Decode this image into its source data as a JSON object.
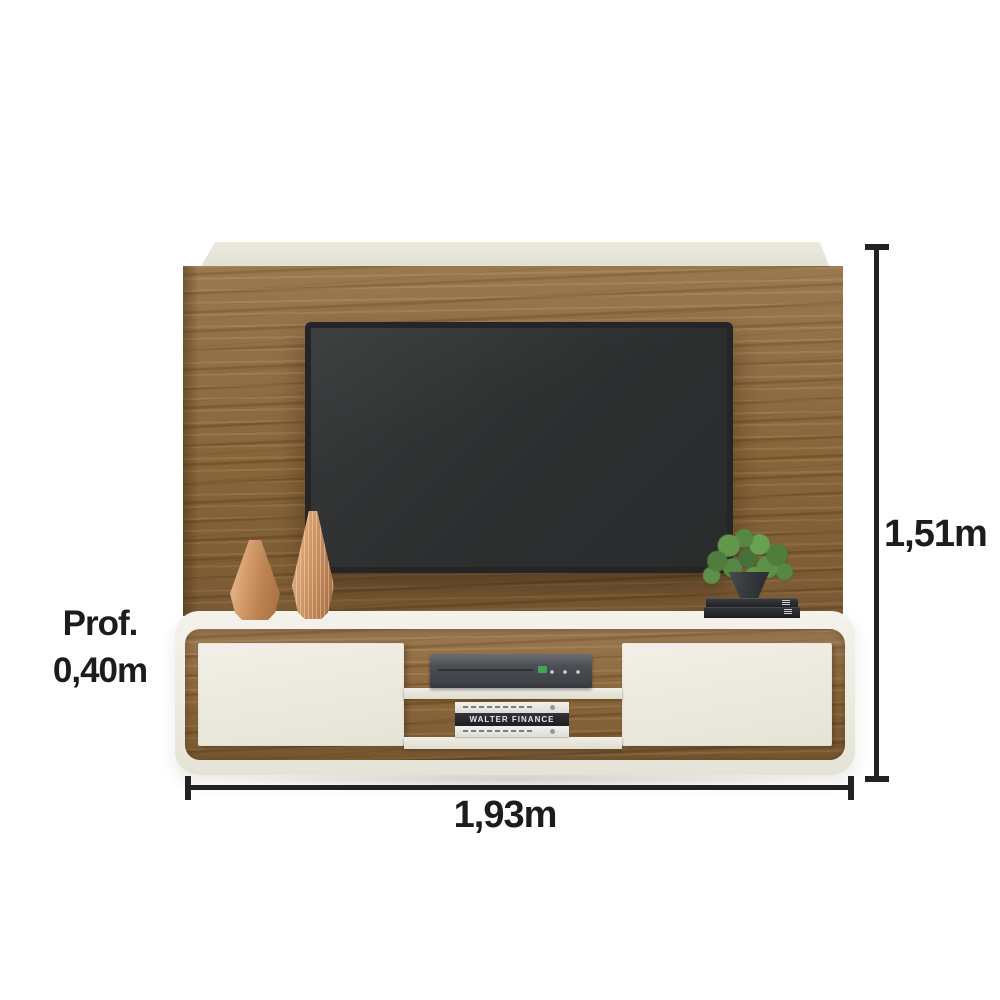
{
  "image": {
    "type": "furniture-product-render",
    "subject": "wall-mounted TV panel with floating cabinet, TV, vases, plant, books and media player"
  },
  "annotations": {
    "height_label": "1,51m",
    "width_label": "1,93m",
    "depth_label_line1": "Prof.",
    "depth_label_line2": "0,40m"
  },
  "decor": {
    "book_spine_title": "WALTER FINANCE"
  },
  "colors": {
    "background": "#ffffff",
    "wood": "#8e693c",
    "off_white_shell": "#efede5",
    "tv_screen": "#2e3031",
    "dimension_lines": "#222222",
    "copper_vases": "#d59d6d",
    "plant_green": "#568743",
    "dvd_logo_green": "#3fae5a"
  }
}
